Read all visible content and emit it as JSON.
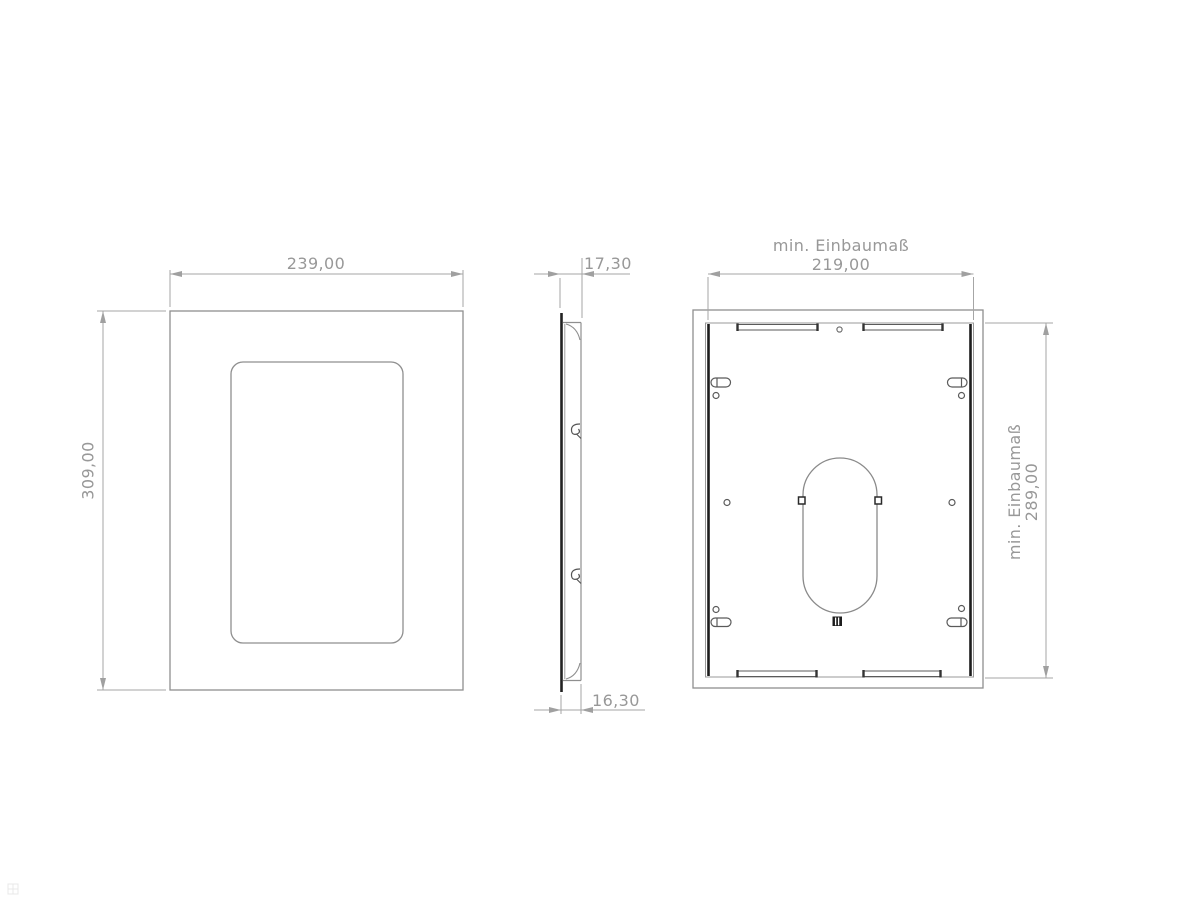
{
  "views": {
    "front": {
      "width_dim": "239,00",
      "height_dim": "309,00"
    },
    "side": {
      "depth_top_dim": "17,30",
      "depth_bottom_dim": "16,30"
    },
    "back": {
      "install_width_label": "min. Einbaumaß",
      "install_width_dim": "219,00",
      "install_height_label": "min. Einbaumaß",
      "install_height_dim": "289,00"
    }
  },
  "colors": {
    "outline": "#8f8f8f",
    "outline_dark": "#1c1c1c",
    "dimension_line": "#a6a6a6",
    "dimension_text": "#989898",
    "background": "#ffffff"
  }
}
